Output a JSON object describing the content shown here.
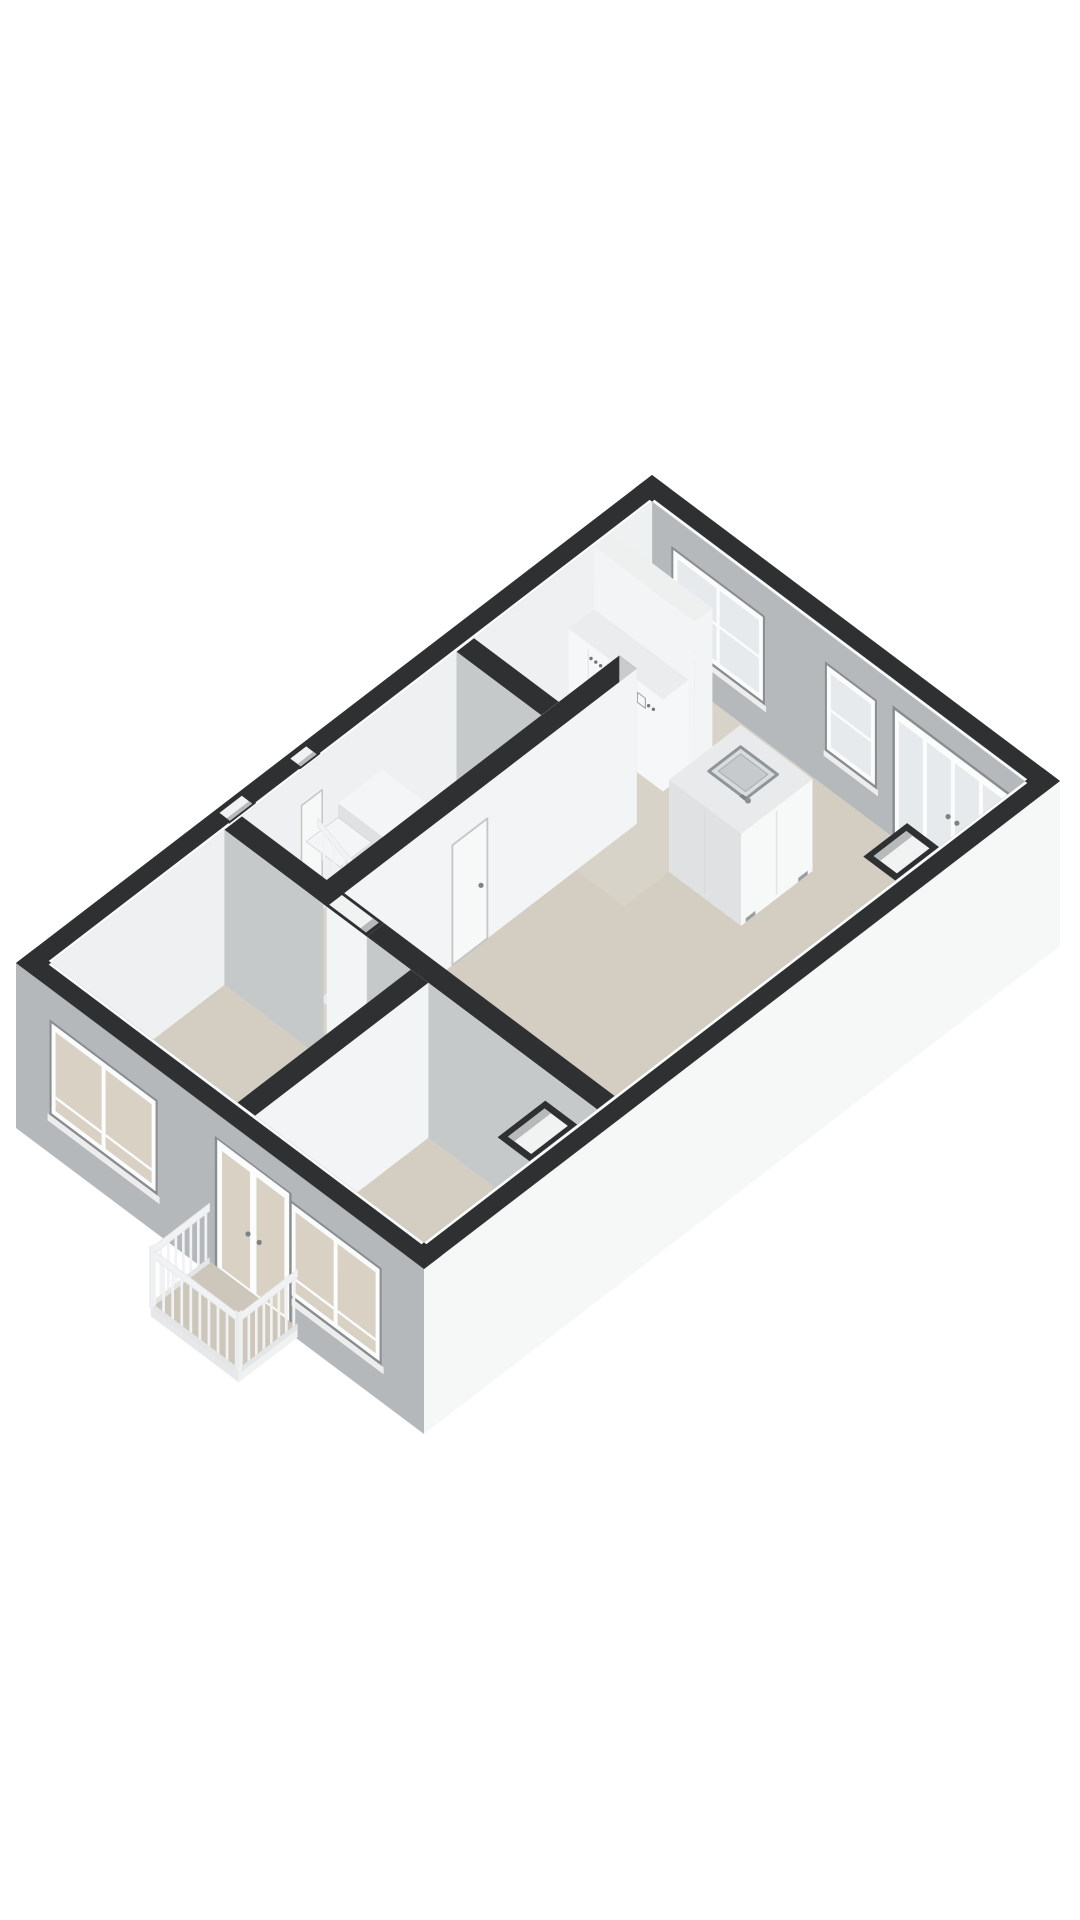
{
  "page": {
    "background": "#ffffff",
    "description": "3D axonometric floor plan render of an apartment storey viewed from the south-east, no text labels"
  },
  "colors": {
    "background": "#ffffff",
    "wall_top": "#2e3031",
    "floor": "#d4cec2",
    "floor_kitchen": "#d8d3c8",
    "floor_hall": "#dad5cb",
    "lip": "#fafbfb",
    "wall_interior_white": "#eff0f1",
    "wall_white_face": "#f3f4f5",
    "wall_gray_face": "#b6b9bb",
    "wall_gray_light": "#c6c9ca",
    "exterior_white": "#f6f7f7",
    "exterior_gray": "#b5b8ba",
    "white_wall_top": "#eef0f0",
    "frame_white": "#fbfcfc",
    "frame_shadow": "#8a8d8f",
    "glass_cool": "#e6eaec",
    "glass_warm": "#d8d1c4",
    "sill": "#ededee",
    "counter_top": "#ebeced",
    "counter_face": "#f6f7f8",
    "counter_seam": "#d7d9da",
    "island_face_gray": "#dfe1e2",
    "island_face_white": "#f7f8f8",
    "island_top": "#e9eaeb",
    "sink_rim": "#8f9698",
    "sink_fill": "#d9dcdd",
    "sink_basin": "#c7cacc",
    "appliance_dark": "#73767a",
    "appliance_rim": "#a7aaac",
    "handle": "#7f8284",
    "stair_white": "#f4f5f6",
    "stair_shade": "#e9ebec",
    "stair_face": "#dfe1e2",
    "tread_edge": "#d2d4d5",
    "railing": "#f1f2f3",
    "railing_shade": "#e3e5e6",
    "balcony_floor": "#cdc7bb",
    "door_white": "#f7f8f8",
    "door_outline": "#c3c5c6",
    "niche_inner": "#f1f2f2",
    "niche_shade": "#b7babb"
  },
  "floorplan": {
    "view": "axonometric-3d",
    "rooms": [
      {
        "name": "living-room-kitchen",
        "floor": "beige"
      },
      {
        "name": "hall-with-stairs",
        "floor": "beige"
      },
      {
        "name": "bedroom-southwest",
        "floor": "beige"
      },
      {
        "name": "bedroom-south",
        "floor": "beige"
      },
      {
        "name": "balcony",
        "floor": "beige"
      }
    ],
    "features": [
      "kitchen-counter-with-cooktop-and-oven-symbols",
      "kitchen-island-with-sink-and-faucet",
      "winder-staircase-with-balustrade",
      "interior-door-on-partition-wall",
      "two-entrance-recesses-on-northwest-wall",
      "doorway-opening-in-bedroom-partition",
      "two-duct-niches-on-southeast-wall",
      "double-window-northeast",
      "single-window-northeast",
      "french-doors-northeast",
      "double-window-southwest-north",
      "balcony-doors-southwest",
      "double-window-southwest-south",
      "balcony-with-slatted-balustrade"
    ],
    "window_counts": {
      "northeast_wall": 3,
      "southwest_wall": 3
    }
  }
}
